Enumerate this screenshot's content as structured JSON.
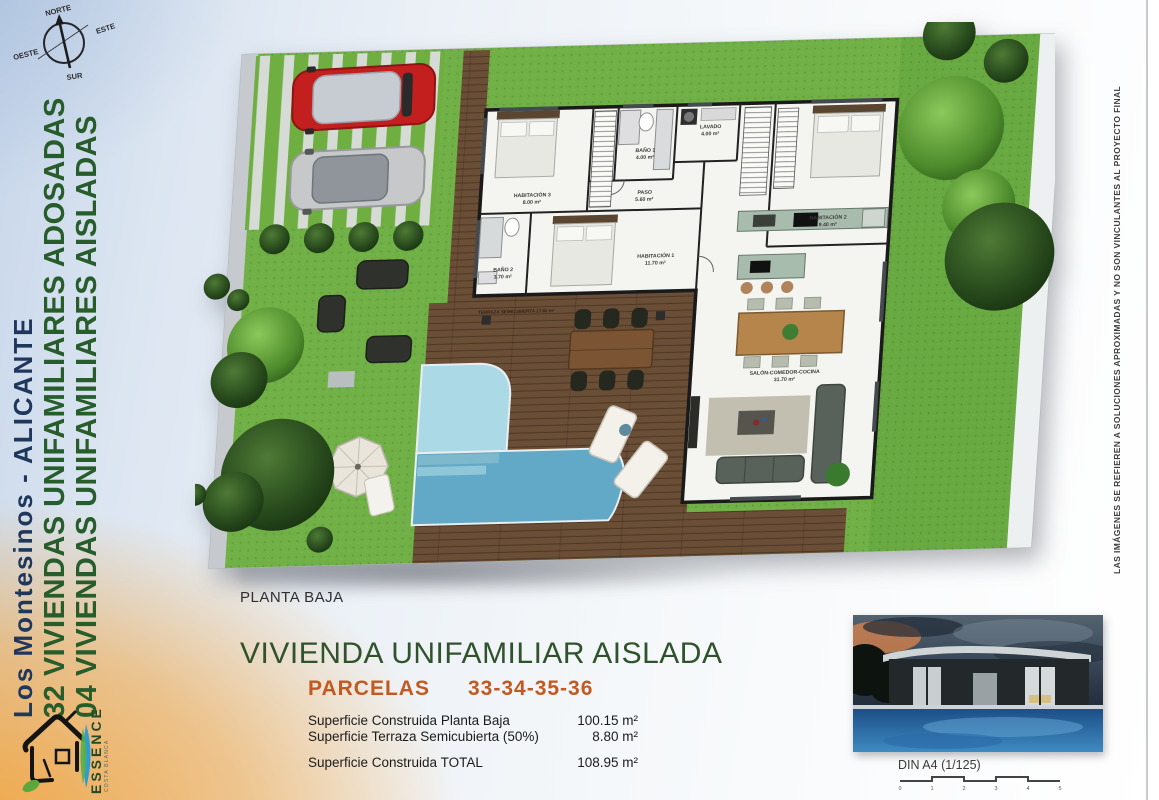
{
  "document": {
    "caption": "PLANTA BAJA",
    "title": "VIVIENDA UNIFAMILIAR AISLADA",
    "parcels_label": "PARCELAS",
    "parcels_numbers": "33-34-35-36"
  },
  "areas_table": {
    "rows": [
      {
        "label": "Superficie Construida Planta Baja",
        "value": "100.15 m²"
      },
      {
        "label": "Superficie Terraza Semicubierta (50%)",
        "value": "8.80 m²"
      },
      {
        "label": "Superficie Construida TOTAL",
        "value": "108.95 m²"
      }
    ]
  },
  "sidebar": {
    "location": "Los Montesinos - ALICANTE",
    "line_adosadas": "32 VIVIENDAS UNIFAMILIARES ADOSADAS",
    "line_aisladas": "04 VIVIENDAS UNIFAMILIARES AISLADAS"
  },
  "compass": {
    "north": "NORTE",
    "east": "ESTE",
    "south": "SUR",
    "west": "OESTE"
  },
  "brand": {
    "name": "ESSENCE",
    "tagline": "COSTA BLANCA"
  },
  "plan_rooms": {
    "hab1": "HABITACIÓN 1",
    "hab1_area": "11.70 m²",
    "hab2": "HABITACIÓN 2",
    "hab2_area": "9.40 m²",
    "hab3": "HABITACIÓN 3",
    "hab3_area": "8.00 m²",
    "bano1": "BAÑO 1",
    "bano1_area": "4.00 m²",
    "bano2": "BAÑO 2",
    "bano2_area": "3.70 m²",
    "lavado": "LAVADO",
    "lavado_area": "4.00 m²",
    "paso": "PASO",
    "paso_area": "5.60 m²",
    "salon": "SALÓN-COMEDOR-COCINA",
    "salon_area": "31.70 m²",
    "terraza": "TERRAZA SEMICUBIERTA 17.60 m²"
  },
  "scale": {
    "label": "DIN A4 (1/125)",
    "ticks": [
      "0",
      "1",
      "2",
      "3",
      "4",
      "5"
    ]
  },
  "disclaimer": "LAS IMÁGENES SE REFIEREN A SOLUCIONES APROXIMADAS Y NO SON VINCULANTES AL PROYECTO FINAL",
  "colors": {
    "title_green": "#30522c",
    "parcels_orange": "#c3591f",
    "sidebar_green": "#275c2b",
    "sidebar_navy": "#20375c",
    "accent_orange": "#f2a03a",
    "lawn_green": "#70b046",
    "pool_blue_light": "#abd9e6",
    "pool_blue_dark": "#61a9c6",
    "deck_brown": "#6b4e36",
    "car_red": "#c31f1f",
    "car_silver": "#c6c8ca"
  }
}
